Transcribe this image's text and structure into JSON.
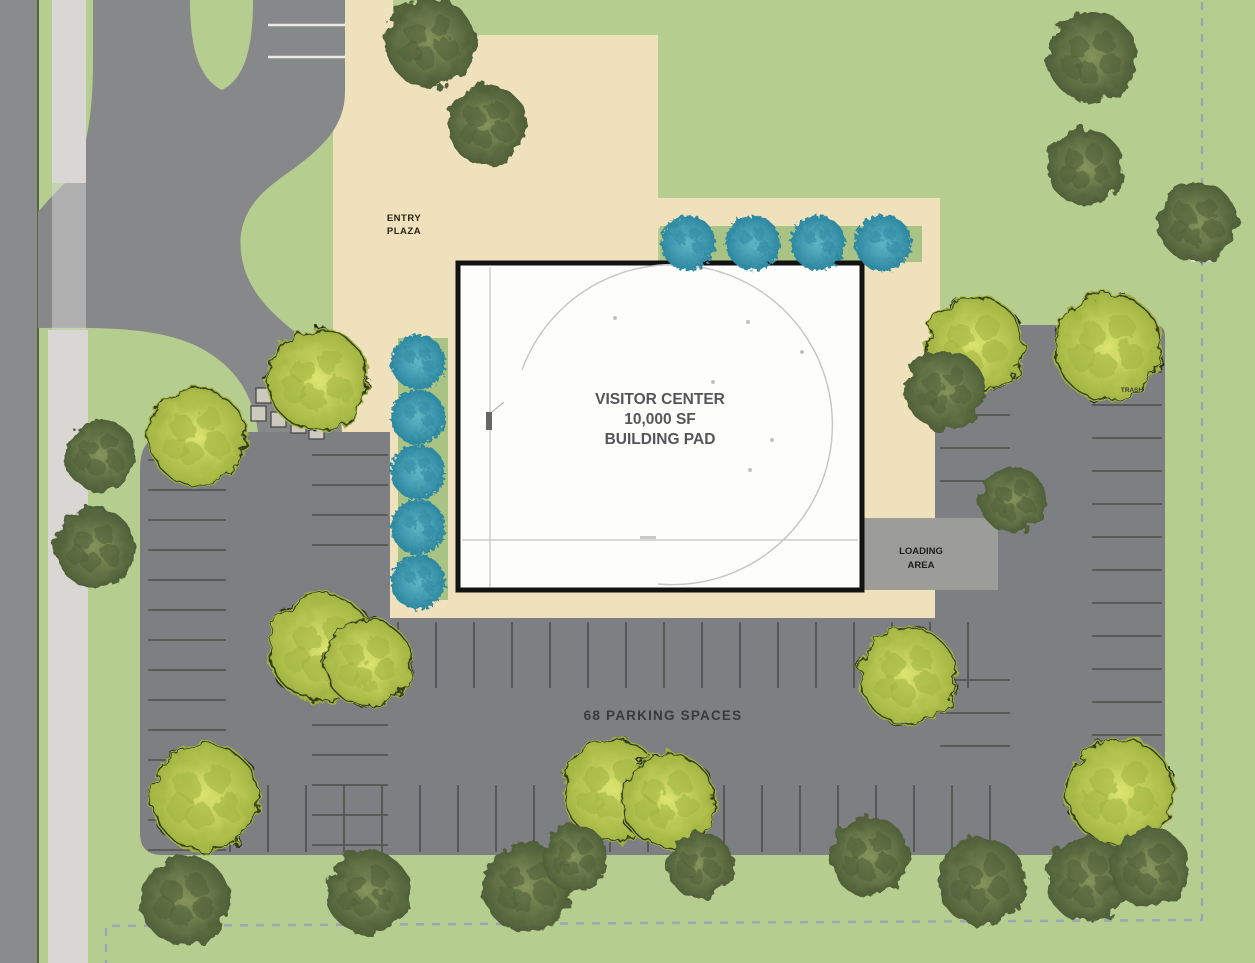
{
  "labels": {
    "entry_line1": "ENTRY",
    "entry_line2": "PLAZA",
    "building_line1": "VISITOR CENTER",
    "building_line2": "10,000 SF",
    "building_line3": "BUILDING PAD",
    "loading_line1": "LOADING",
    "loading_line2": "AREA",
    "parking_count": "68 PARKING SPACES",
    "trash": "TRASH"
  },
  "colors": {
    "grass": "#b6cd90",
    "road": "#8a8b8d",
    "driveway": "#87888a",
    "parking": "#7e7f82",
    "sidewalk": "#d8d7d3",
    "plaza": "#f0e1bd",
    "bed": "#a9c384",
    "loading": "#9c9c99",
    "building_fill": "#fdfdfc",
    "building_border": "#121212",
    "stripe": "#4e4e4a",
    "white_stripe": "#ecebe6",
    "crosswalk_fill": "#cdc9bf",
    "tree_yellow_light": "#dce56f",
    "tree_yellow_dark": "#9fb23f",
    "tree_green_light": "#86955c",
    "tree_green_dark": "#4f5f38",
    "tree_teal_light": "#5fb6c6",
    "tree_teal_dark": "#2f89a2",
    "boundary": "#98a3b8",
    "outline": "#22281a",
    "text_dark": "#2b2317",
    "text_gray": "#56565a",
    "text_parking": "#3a3a3c",
    "road_edge": "#54663f",
    "faint_line": "#c4c4c4"
  }
}
